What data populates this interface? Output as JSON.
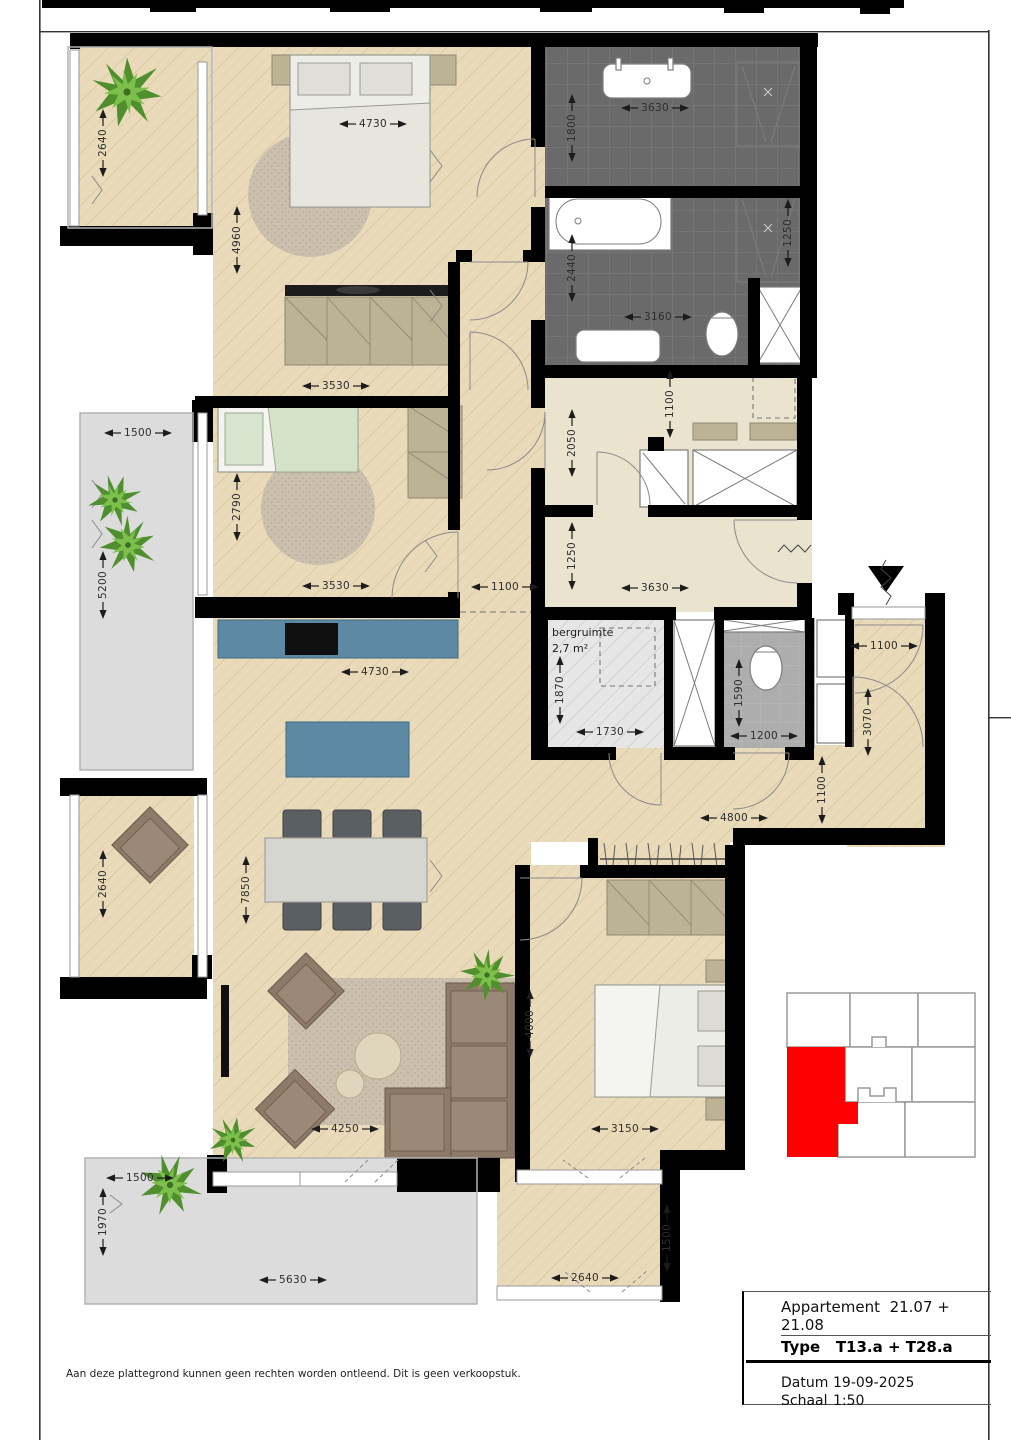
{
  "title_block": {
    "apartment_label": "Appartement",
    "apartment_value": "21.07 + 21.08",
    "type_label": "Type",
    "type_value": "T13.a + T28.a",
    "date_label": "Datum",
    "date_value": "19-09-2025",
    "scale_label": "Schaal",
    "scale_value": "1:50"
  },
  "disclaimer": "Aan deze plattegrond kunnen geen rechten worden ontleend. Dit is geen verkoopstuk.",
  "rooms": {
    "storage_label": "bergruimte",
    "storage_area": "2,7 m²"
  },
  "dims": {
    "d2640": "2640",
    "d4730": "4730",
    "d4960": "4960",
    "d3630": "3630",
    "d1800": "1800",
    "d2440": "2440",
    "d1250": "1250",
    "d3160": "3160",
    "d3530": "3530",
    "d1500": "1500",
    "d2790": "2790",
    "d5200": "5200",
    "d1100": "1100",
    "d2050": "2050",
    "d1870": "1870",
    "d1730": "1730",
    "d1590": "1590",
    "d1200": "1200",
    "d3070": "3070",
    "d4800": "4800",
    "d7850": "7850",
    "d4250": "4250",
    "d4000": "4000",
    "d3150": "3150",
    "d1970": "1970",
    "d5630": "5630"
  },
  "colors": {
    "wall": "#000000",
    "wood_floor": "#e9dab9",
    "tile_dark": "#6a6a6a",
    "toilet_gray": "#adadad",
    "hall_beige": "#eae3cd",
    "terrace_gray": "#dcdcdc",
    "kitchen_blue": "#5d89a4",
    "furniture_tan": "#bcb294",
    "sofa_brown": "#8d7a68",
    "plant_green": "#4f8f2e",
    "keyplan_highlight": "#fe0000"
  },
  "icons": {
    "entrance_marker": "entrance-triangle"
  }
}
